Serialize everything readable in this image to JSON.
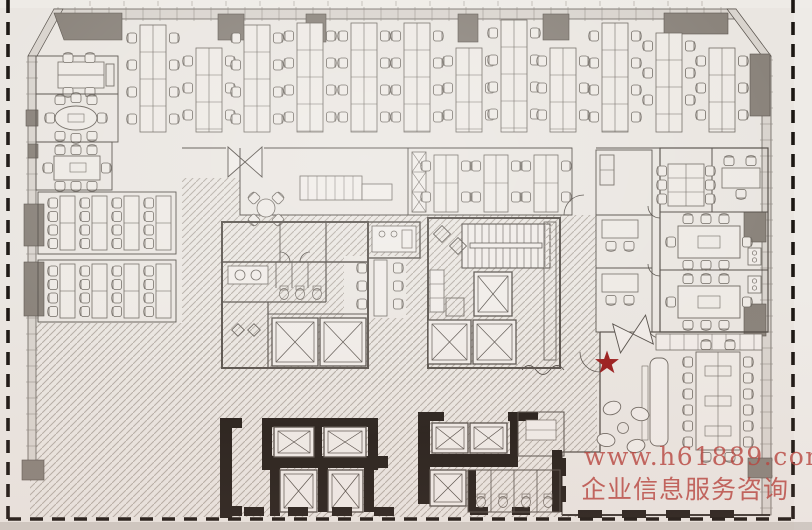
{
  "photo": {
    "paper_color": "#eae6e1",
    "paper_light": "#f0ece8",
    "bottom_edge_color": "#b7b1ab",
    "right_edge_color": "#f0ede9"
  },
  "boundary": {
    "style": "dashed",
    "color": "#1c1713"
  },
  "plan_colors": {
    "wall_line": "#56504a",
    "heavy_wall": "#26201b",
    "column_gray": "#8a837b",
    "column_edge": "#5c564f",
    "curtain_band": "#d9d4ce",
    "hatch_line": "#b5aea6",
    "furniture_line": "#6f6962",
    "furniture_fill": "#eeeae5",
    "floor_light": "#edе9e4"
  },
  "marker": {
    "shape": "star",
    "color": "#9a1d1d"
  },
  "watermark": {
    "line1": "www.h61889.com",
    "line2": "企业信息服务咨询",
    "color": "#b8463f"
  }
}
